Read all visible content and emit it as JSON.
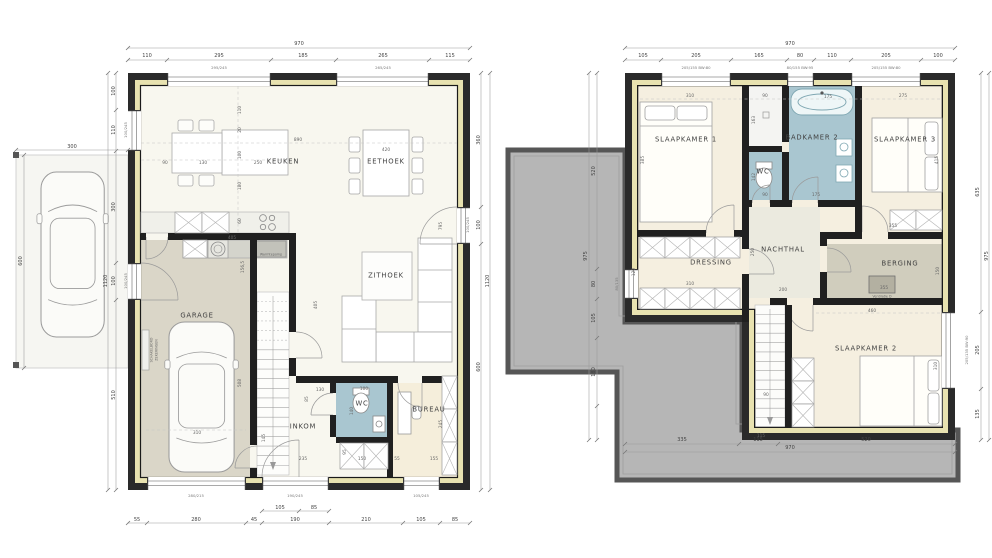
{
  "document": {
    "type": "architectural-floorplan",
    "sheets": [
      "ground-floor",
      "upper-floor"
    ]
  },
  "colors": {
    "wall": "#2a2a2a",
    "insulation": "#e8e2b0",
    "wet_room": "#a9c6d0",
    "garage_floor": "#dad6c8",
    "bedroom_floor": "#f5efe0",
    "living_floor": "#f8f7ef",
    "storage_floor": "#d0cdbd",
    "flat_roof": "#b6b6b6",
    "dim_text": "#4a4a4a"
  },
  "ground_floor": {
    "rooms": [
      "KEUKEN",
      "EETHOEK",
      "ZITHOEK",
      "GARAGE",
      "INKOM",
      "WC",
      "BUREAU"
    ],
    "overall_dimensions": {
      "width": "970",
      "depth": "1120"
    },
    "labels": [
      {
        "t": "KEUKEN",
        "x": 283,
        "y": 162,
        "k": "room"
      },
      {
        "t": "EETHOEK",
        "x": 386,
        "y": 162,
        "k": "room"
      },
      {
        "t": "ZITHOEK",
        "x": 386,
        "y": 276,
        "k": "room"
      },
      {
        "t": "GARAGE",
        "x": 197,
        "y": 316,
        "k": "room"
      },
      {
        "t": "INKOM",
        "x": 303,
        "y": 427,
        "k": "room"
      },
      {
        "t": "WC",
        "x": 362,
        "y": 404,
        "k": "room"
      },
      {
        "t": "BUREAU",
        "x": 429,
        "y": 410,
        "k": "room"
      },
      {
        "t": "970",
        "x": 299,
        "y": 44,
        "k": "dim"
      },
      {
        "t": "110",
        "x": 147,
        "y": 56,
        "k": "dim"
      },
      {
        "t": "295",
        "x": 219,
        "y": 56,
        "k": "dim"
      },
      {
        "t": "185",
        "x": 303,
        "y": 56,
        "k": "dim"
      },
      {
        "t": "265",
        "x": 383,
        "y": 56,
        "k": "dim"
      },
      {
        "t": "115",
        "x": 450,
        "y": 56,
        "k": "dim"
      },
      {
        "t": "295/245",
        "x": 219,
        "y": 68,
        "k": "win"
      },
      {
        "t": "265/245",
        "x": 383,
        "y": 68,
        "k": "win"
      },
      {
        "t": "55",
        "x": 137,
        "y": 520,
        "k": "dim"
      },
      {
        "t": "280",
        "x": 196,
        "y": 520,
        "k": "dim"
      },
      {
        "t": "45",
        "x": 254,
        "y": 520,
        "k": "dim"
      },
      {
        "t": "190",
        "x": 295,
        "y": 520,
        "k": "dim"
      },
      {
        "t": "210",
        "x": 366,
        "y": 520,
        "k": "dim"
      },
      {
        "t": "105",
        "x": 421,
        "y": 520,
        "k": "dim"
      },
      {
        "t": "85",
        "x": 455,
        "y": 520,
        "k": "dim"
      },
      {
        "t": "105",
        "x": 280,
        "y": 508,
        "k": "dim"
      },
      {
        "t": "85",
        "x": 314,
        "y": 508,
        "k": "dim"
      },
      {
        "t": "280/215",
        "x": 196,
        "y": 496,
        "k": "win"
      },
      {
        "t": "190/245",
        "x": 295,
        "y": 496,
        "k": "win"
      },
      {
        "t": "105/245",
        "x": 421,
        "y": 496,
        "k": "win"
      },
      {
        "t": "100",
        "x": 114,
        "y": 91,
        "k": "dim",
        "r": 1
      },
      {
        "t": "110",
        "x": 114,
        "y": 130,
        "k": "dim",
        "r": 1
      },
      {
        "t": "300",
        "x": 114,
        "y": 207,
        "k": "dim",
        "r": 1
      },
      {
        "t": "100",
        "x": 114,
        "y": 281,
        "k": "dim",
        "r": 1
      },
      {
        "t": "510",
        "x": 114,
        "y": 395,
        "k": "dim",
        "r": 1
      },
      {
        "t": "1120",
        "x": 106,
        "y": 281,
        "k": "dim",
        "r": 1
      },
      {
        "t": "100/245",
        "x": 126,
        "y": 130,
        "k": "win",
        "r": 1
      },
      {
        "t": "100/245",
        "x": 126,
        "y": 281,
        "k": "win",
        "r": 1
      },
      {
        "t": "360",
        "x": 479,
        "y": 140,
        "k": "dim",
        "r": 1
      },
      {
        "t": "100",
        "x": 479,
        "y": 225,
        "k": "dim",
        "r": 1
      },
      {
        "t": "600",
        "x": 479,
        "y": 367,
        "k": "dim",
        "r": 1
      },
      {
        "t": "1120",
        "x": 488,
        "y": 281,
        "k": "dim",
        "r": 1
      },
      {
        "t": "100/245",
        "x": 468,
        "y": 225,
        "k": "win",
        "r": 1
      },
      {
        "t": "300",
        "x": 72,
        "y": 147,
        "k": "dim"
      },
      {
        "t": "600",
        "x": 21,
        "y": 261,
        "k": "dim",
        "r": 1
      },
      {
        "t": "90",
        "x": 165,
        "y": 163,
        "k": "idim"
      },
      {
        "t": "130",
        "x": 203,
        "y": 163,
        "k": "idim"
      },
      {
        "t": "250",
        "x": 258,
        "y": 163,
        "k": "idim"
      },
      {
        "t": "890",
        "x": 298,
        "y": 140,
        "k": "idim"
      },
      {
        "t": "420",
        "x": 386,
        "y": 150,
        "k": "idim"
      },
      {
        "t": "110",
        "x": 240,
        "y": 110,
        "k": "idim",
        "r": 1
      },
      {
        "t": "20",
        "x": 240,
        "y": 130,
        "k": "idim",
        "r": 1
      },
      {
        "t": "100",
        "x": 240,
        "y": 155,
        "k": "idim",
        "r": 1
      },
      {
        "t": "180",
        "x": 240,
        "y": 186,
        "k": "idim",
        "r": 1
      },
      {
        "t": "60",
        "x": 240,
        "y": 221,
        "k": "idim",
        "r": 1
      },
      {
        "t": "795",
        "x": 441,
        "y": 226,
        "k": "idim",
        "r": 1
      },
      {
        "t": "405",
        "x": 232,
        "y": 238,
        "k": "idim"
      },
      {
        "t": "156,5",
        "x": 243,
        "y": 267,
        "k": "idim",
        "r": 1
      },
      {
        "t": "508",
        "x": 240,
        "y": 383,
        "k": "idim",
        "r": 1
      },
      {
        "t": "405",
        "x": 316,
        "y": 305,
        "k": "idim",
        "r": 1
      },
      {
        "t": "310",
        "x": 197,
        "y": 433,
        "k": "idim"
      },
      {
        "t": "130",
        "x": 320,
        "y": 390,
        "k": "idim"
      },
      {
        "t": "85",
        "x": 307,
        "y": 399,
        "k": "idim",
        "r": 1
      },
      {
        "t": "145",
        "x": 264,
        "y": 438,
        "k": "idim",
        "r": 1
      },
      {
        "t": "235",
        "x": 303,
        "y": 459,
        "k": "idim"
      },
      {
        "t": "100",
        "x": 364,
        "y": 389,
        "k": "idim"
      },
      {
        "t": "140",
        "x": 352,
        "y": 411,
        "k": "idim",
        "r": 1
      },
      {
        "t": "150",
        "x": 362,
        "y": 459,
        "k": "idim"
      },
      {
        "t": "95",
        "x": 345,
        "y": 452,
        "k": "idim",
        "r": 1
      },
      {
        "t": "55",
        "x": 397,
        "y": 459,
        "k": "idim"
      },
      {
        "t": "155",
        "x": 434,
        "y": 459,
        "k": "idim"
      },
      {
        "t": "245",
        "x": 441,
        "y": 424,
        "k": "idim",
        "r": 1
      },
      {
        "t": "Warmtepomp",
        "x": 271,
        "y": 255,
        "k": "note"
      },
      {
        "t": "SCHAKELBORD",
        "x": 152,
        "y": 350,
        "k": "note",
        "r": 1
      },
      {
        "t": "ZEKERINGEN",
        "x": 157,
        "y": 350,
        "k": "note",
        "r": 1
      }
    ]
  },
  "upper_floor": {
    "rooms": [
      "SLAAPKAMER 1",
      "BADKAMER 2",
      "SLAAPKAMER 3",
      "WC",
      "DRESSING",
      "NACHTHAL",
      "BERGING",
      "SLAAPKAMER 2"
    ],
    "overall_dimensions": {
      "width": "970",
      "depth": "975"
    },
    "labels": [
      {
        "t": "SLAAPKAMER 1",
        "x": 686,
        "y": 140,
        "k": "room"
      },
      {
        "t": "BADKAMER 2",
        "x": 812,
        "y": 138,
        "k": "room"
      },
      {
        "t": "SLAAPKAMER 3",
        "x": 905,
        "y": 140,
        "k": "room"
      },
      {
        "t": "WC",
        "x": 763,
        "y": 172,
        "k": "room"
      },
      {
        "t": "DRESSING",
        "x": 711,
        "y": 263,
        "k": "room"
      },
      {
        "t": "NACHTHAL",
        "x": 783,
        "y": 250,
        "k": "room"
      },
      {
        "t": "BERGING",
        "x": 900,
        "y": 264,
        "k": "room"
      },
      {
        "t": "SLAAPKAMER 2",
        "x": 866,
        "y": 349,
        "k": "room"
      },
      {
        "t": "970",
        "x": 790,
        "y": 44,
        "k": "dim"
      },
      {
        "t": "105",
        "x": 643,
        "y": 56,
        "k": "dim"
      },
      {
        "t": "205",
        "x": 696,
        "y": 56,
        "k": "dim"
      },
      {
        "t": "165",
        "x": 759,
        "y": 56,
        "k": "dim"
      },
      {
        "t": "80",
        "x": 800,
        "y": 56,
        "k": "dim"
      },
      {
        "t": "110",
        "x": 832,
        "y": 56,
        "k": "dim"
      },
      {
        "t": "205",
        "x": 886,
        "y": 56,
        "k": "dim"
      },
      {
        "t": "100",
        "x": 938,
        "y": 56,
        "k": "dim"
      },
      {
        "t": "205/155 BW:80",
        "x": 696,
        "y": 68,
        "k": "win"
      },
      {
        "t": "80/155 BW:95",
        "x": 800,
        "y": 68,
        "k": "win"
      },
      {
        "t": "205/155 BW:80",
        "x": 886,
        "y": 68,
        "k": "win"
      },
      {
        "t": "335",
        "x": 682,
        "y": 440,
        "k": "dim"
      },
      {
        "t": "115",
        "x": 758,
        "y": 440,
        "k": "dim"
      },
      {
        "t": "520",
        "x": 866,
        "y": 440,
        "k": "dim"
      },
      {
        "t": "970",
        "x": 790,
        "y": 448,
        "k": "dim"
      },
      {
        "t": "635",
        "x": 978,
        "y": 192,
        "k": "dim",
        "r": 1
      },
      {
        "t": "205",
        "x": 978,
        "y": 350,
        "k": "dim",
        "r": 1
      },
      {
        "t": "135",
        "x": 978,
        "y": 414,
        "k": "dim",
        "r": 1
      },
      {
        "t": "975",
        "x": 987,
        "y": 256,
        "k": "dim",
        "r": 1
      },
      {
        "t": "205/135 BW:90",
        "x": 967,
        "y": 350,
        "k": "win",
        "r": 1
      },
      {
        "t": "520",
        "x": 594,
        "y": 171,
        "k": "dim",
        "r": 1
      },
      {
        "t": "80",
        "x": 594,
        "y": 284,
        "k": "dim",
        "r": 1
      },
      {
        "t": "105",
        "x": 594,
        "y": 318,
        "k": "dim",
        "r": 1
      },
      {
        "t": "180",
        "x": 594,
        "y": 372,
        "k": "dim",
        "r": 1
      },
      {
        "t": "975",
        "x": 586,
        "y": 256,
        "k": "dim",
        "r": 1
      },
      {
        "t": "80/135",
        "x": 617,
        "y": 284,
        "k": "win",
        "r": 1
      },
      {
        "t": "310",
        "x": 690,
        "y": 96,
        "k": "idim"
      },
      {
        "t": "385",
        "x": 643,
        "y": 160,
        "k": "idim",
        "r": 1
      },
      {
        "t": "90",
        "x": 765,
        "y": 96,
        "k": "idim"
      },
      {
        "t": "163",
        "x": 754,
        "y": 120,
        "k": "idim",
        "r": 1
      },
      {
        "t": "142",
        "x": 754,
        "y": 177,
        "k": "idim",
        "r": 1
      },
      {
        "t": "90",
        "x": 765,
        "y": 195,
        "k": "idim"
      },
      {
        "t": "175",
        "x": 828,
        "y": 97,
        "k": "idim"
      },
      {
        "t": "175",
        "x": 816,
        "y": 195,
        "k": "idim"
      },
      {
        "t": "275",
        "x": 903,
        "y": 96,
        "k": "idim"
      },
      {
        "t": "415",
        "x": 937,
        "y": 160,
        "k": "idim",
        "r": 1
      },
      {
        "t": "355",
        "x": 893,
        "y": 226,
        "k": "idim"
      },
      {
        "t": "310",
        "x": 690,
        "y": 284,
        "k": "idim"
      },
      {
        "t": "120",
        "x": 634,
        "y": 272,
        "k": "idim",
        "r": 1
      },
      {
        "t": "250",
        "x": 753,
        "y": 252,
        "k": "idim",
        "r": 1
      },
      {
        "t": "200",
        "x": 783,
        "y": 290,
        "k": "idim"
      },
      {
        "t": "355",
        "x": 884,
        "y": 288,
        "k": "idim"
      },
      {
        "t": "150",
        "x": 938,
        "y": 271,
        "k": "idim",
        "r": 1
      },
      {
        "t": "460",
        "x": 872,
        "y": 311,
        "k": "idim"
      },
      {
        "t": "310",
        "x": 936,
        "y": 366,
        "k": "idim",
        "r": 1
      },
      {
        "t": "90",
        "x": 766,
        "y": 395,
        "k": "idim"
      },
      {
        "t": "115",
        "x": 761,
        "y": 436,
        "k": "idim"
      },
      {
        "t": "Ventilatie D",
        "x": 882,
        "y": 297,
        "k": "note"
      }
    ]
  }
}
